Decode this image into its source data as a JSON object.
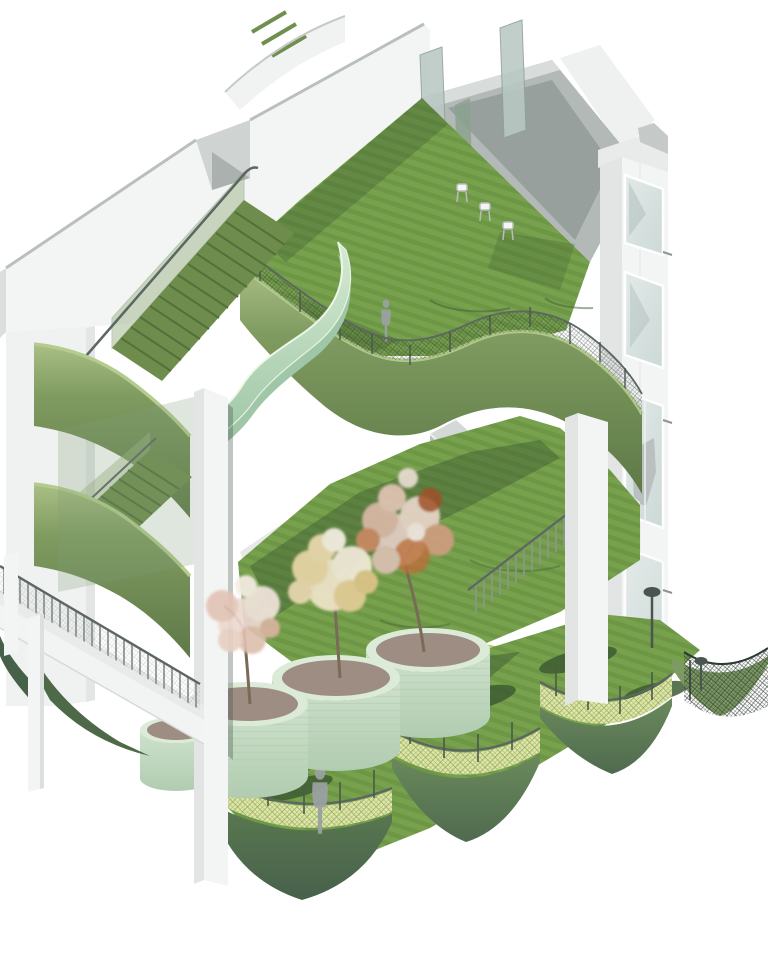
{
  "scene": {
    "title": "Axonometric cutaway rendering of a terraced building with green roofs, winding ramp, trees in round planters and scalloped balconies",
    "view": "axonometric",
    "figure_count": 2,
    "tree_count": 3,
    "planter_count": 4
  },
  "colors": {
    "background": "#ffffff",
    "wall_white": "#f3f5f4",
    "wall_shade": "#e2e5e4",
    "wall_edge": "#c5cac8",
    "concrete": "#b2b9b6",
    "concrete_dark": "#98a09d",
    "glass": "#ccd9d7",
    "glass_light": "#e2eae8",
    "glass_fin": "#b9c8c3",
    "lawn": "#77a14d",
    "lawn_stripe": "#6d9645",
    "lawn_shadow": "#3f5c33",
    "fascia_light": "#aabf85",
    "fascia": "#7f9b60",
    "fascia_dark": "#5e7947",
    "fascia_deep": "#5a7850",
    "fascia_deep_dark": "#47614b",
    "mint_light": "#d4ead2",
    "mint": "#c2e0c5",
    "mint_dark": "#9fc6a6",
    "planter": "#cfe2cc",
    "planter_dark": "#b0ccb0",
    "soil": "#9d8d83",
    "mesh_yellow": "#dde8a6",
    "mesh_yellow_line": "#9aa868",
    "rail": "#5c6663",
    "rail_dark": "#2e3a33",
    "stair_green": "#6e8d4c",
    "stair_line": "#52703a",
    "table": "#cfe08b",
    "figure": "#9aa1a1",
    "trunk": "#7a6a58",
    "tree_pink": "#ecd9d0",
    "tree_cream": "#ead9ae",
    "tree_white": "#f4ede4",
    "tree_orange": "#c06b38",
    "tree_rust": "#a54e27"
  }
}
